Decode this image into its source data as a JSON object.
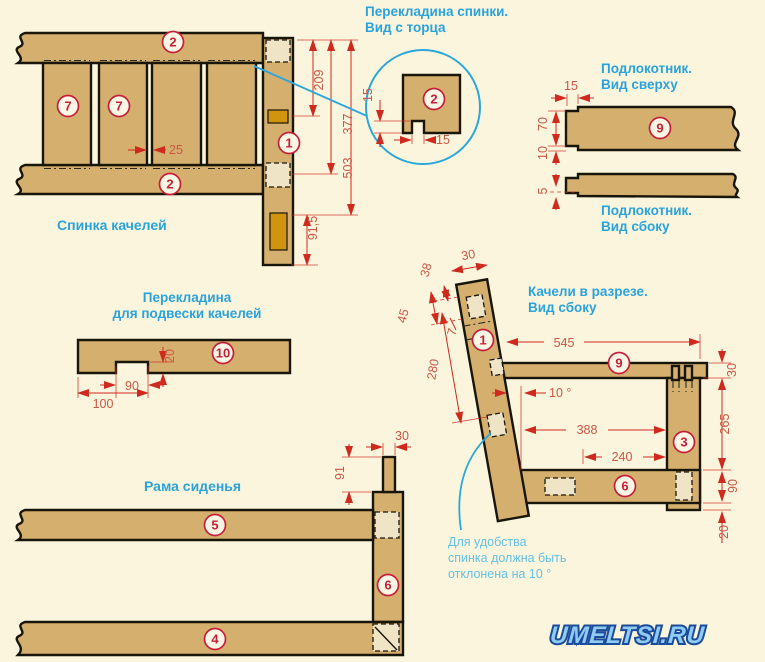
{
  "colors": {
    "background": "#FCF5DE",
    "wood": "#D5AF6E",
    "mortise_light": "#EFE4C6",
    "slot_dark": "#D0940F",
    "outline": "#18150B",
    "dimension_red": "#CE2A1E",
    "dimension_text": "#C75845",
    "label_blue": "#29A3DC",
    "note_blue": "#64C1E4",
    "part_red": "#C51F3C",
    "watermark_blue": "#1B4C9B"
  },
  "back_frame": {
    "title": "Спинка качелей",
    "part_rail": "2",
    "part_slat": "7",
    "part_post": "1",
    "dim_gap": "25",
    "dim_a": "209",
    "dim_b": "377",
    "dim_c": "503",
    "dim_d": "91,5"
  },
  "rail_detail": {
    "title1": "Перекладина спинки.",
    "title2": "Вид с торца",
    "part": "2",
    "dim_v": "15",
    "dim_h": "15"
  },
  "armrest": {
    "title_top1": "Подлокотник.",
    "title_top2": "Вид сверху",
    "title_side1": "Подлокотник.",
    "title_side2": "Вид сбоку",
    "part": "9",
    "dim_tab": "15",
    "dim_width": "70",
    "dim_offset": "10",
    "dim_thick": "5"
  },
  "hanger": {
    "title1": "Перекладина",
    "title2": "для подвески качелей",
    "part": "10",
    "dim_depth": "20",
    "dim_notch": "90",
    "dim_edge": "100"
  },
  "section": {
    "title1": "Качели в разрезе.",
    "title2": "Вид сбоку",
    "part_back_post": "1",
    "part_armrest": "9",
    "part_front_post": "3",
    "part_side_rail": "6",
    "dim_top_width": "30",
    "dim_38": "38",
    "dim_45": "45",
    "dim_7": "7",
    "dim_280": "280",
    "dim_545": "545",
    "dim_angle": "10 °",
    "dim_388": "388",
    "dim_240": "240",
    "dim_30": "30",
    "dim_265": "265",
    "dim_90": "90",
    "dim_20": "20",
    "note1": "Для удобства",
    "note2": "спинка должна быть",
    "note3": "отклонена на 10 °"
  },
  "seat_frame": {
    "title": "Рама сиденья",
    "part_top_rail": "5",
    "part_bottom_rail": "4",
    "part_post": "6",
    "dim_tenon": "30",
    "dim_len": "91"
  },
  "watermark": "UMELTSI.RU"
}
